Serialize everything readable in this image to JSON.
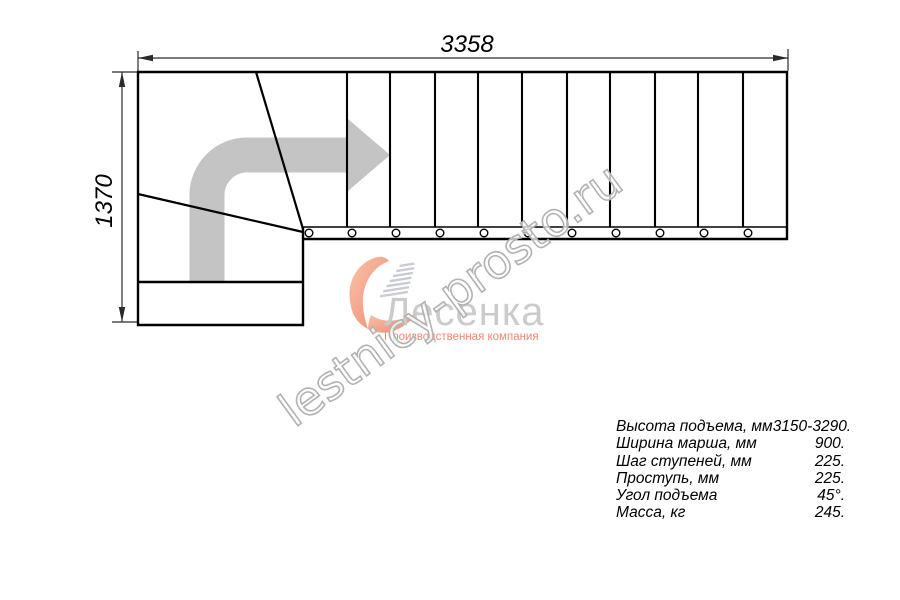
{
  "drawing": {
    "title": "L-shaped staircase plan view",
    "dimensions": {
      "width_label": "3358",
      "height_label": "1370"
    }
  },
  "specs": {
    "rows": [
      {
        "label": "Высота подъема, мм",
        "value": "3150-3290."
      },
      {
        "label": "Ширина марша, мм",
        "value": "900."
      },
      {
        "label": "Шаг ступеней, мм",
        "value": "225."
      },
      {
        "label": "Проступь, мм",
        "value": "225."
      },
      {
        "label": "Угол подъема",
        "value": "45°."
      },
      {
        "label": "Масса, кг",
        "value": "245."
      }
    ]
  },
  "logo": {
    "name": "Лесенка",
    "tagline": "Производственная компания"
  },
  "watermark": {
    "text": "lestnicy-prosto.ru"
  },
  "colors": {
    "line": "#000000",
    "dimension_line": "#2a2a2a",
    "direction_arrow": "#c4c4c4",
    "logo_name_gray": "#cbcbcb",
    "logo_salmon": "#f28872",
    "heart_salmon": "#f4a68f",
    "watermark_outline": "#b2b2b2"
  }
}
